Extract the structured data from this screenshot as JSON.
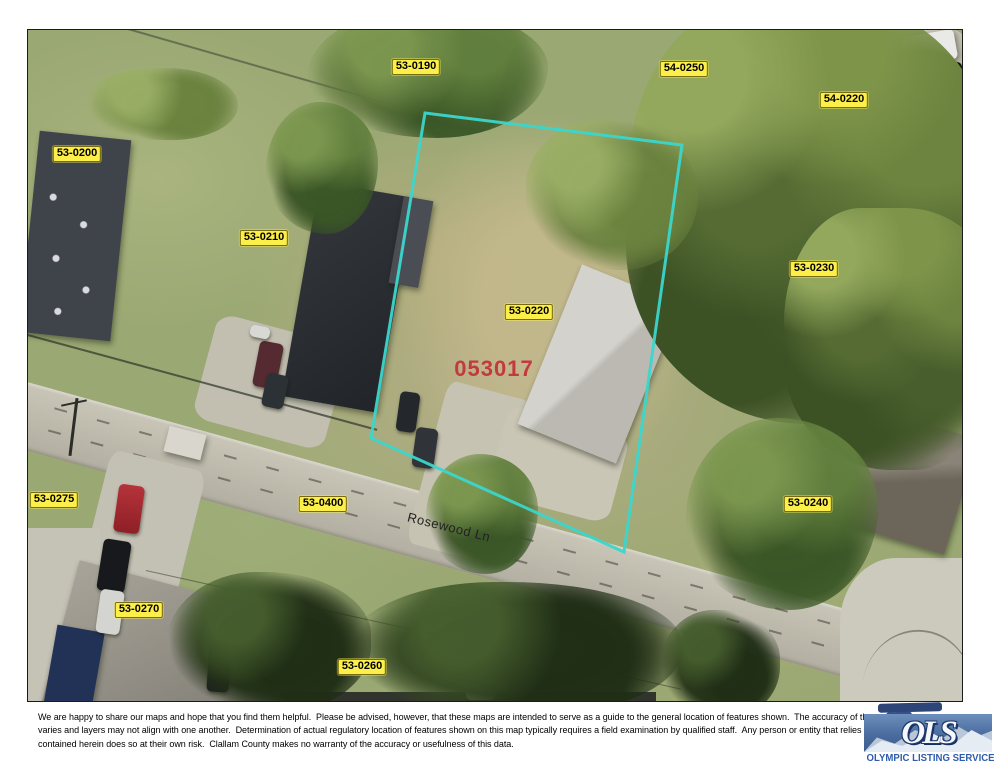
{
  "map": {
    "parcel_labels": [
      {
        "text": "53-0190",
        "x": 388,
        "y": 37
      },
      {
        "text": "54-0250",
        "x": 656,
        "y": 39
      },
      {
        "text": "54-0220",
        "x": 816,
        "y": 70
      },
      {
        "text": "53-0200",
        "x": 49,
        "y": 124
      },
      {
        "text": "53-0210",
        "x": 236,
        "y": 208
      },
      {
        "text": "53-0230",
        "x": 786,
        "y": 239
      },
      {
        "text": "53-0220",
        "x": 501,
        "y": 282
      },
      {
        "text": "53-0275",
        "x": 26,
        "y": 470
      },
      {
        "text": "53-0400",
        "x": 295,
        "y": 474
      },
      {
        "text": "53-0240",
        "x": 780,
        "y": 474
      },
      {
        "text": "53-0270",
        "x": 111,
        "y": 580
      },
      {
        "text": "53-0260",
        "x": 334,
        "y": 637
      }
    ],
    "parcel_id": {
      "text": "053017",
      "color": "#c23a3e",
      "x": 466,
      "y": 339
    },
    "street": {
      "name": "Rosewood Ln",
      "x": 421,
      "y": 497,
      "angle": 14
    },
    "parcel_outline": {
      "color": "#3bd6cc",
      "points": [
        [
          397,
          83
        ],
        [
          654,
          115
        ],
        [
          596,
          522
        ],
        [
          343,
          408
        ]
      ]
    },
    "label_colors": {
      "bg": "#fdef49",
      "text": "#000000"
    }
  },
  "footer": {
    "disclaimer": [
      "We are happy to share our maps and hope that you find them helpful.  Please be advised, however, that these maps are intended to serve as a guide to the general location of features shown.  The accuracy of the",
      "varies and layers may not align with one another.  Determination of actual regulatory location of features shown on this map typically requires a field examination by qualified staff.  Any person or entity that relies o",
      "contained herein does so at their own risk.  Clallam County makes no warranty of the accuracy or usefulness of this data."
    ],
    "logo": {
      "initials": "OLS",
      "name": "OLYMPIC LISTING SERVICE"
    }
  }
}
